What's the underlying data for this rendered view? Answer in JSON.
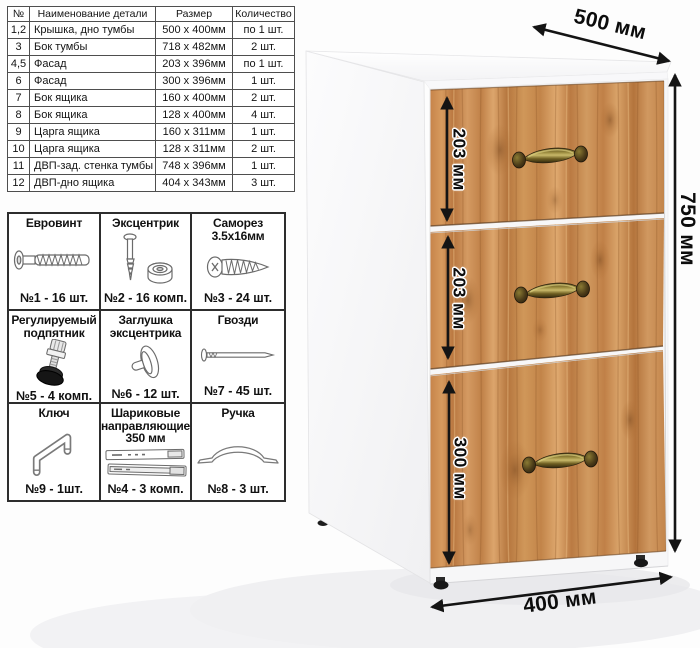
{
  "parts_table": {
    "headers": [
      "№",
      "Наименование детали",
      "Размер",
      "Количество"
    ],
    "rows": [
      [
        "1,2",
        "Крышка, дно тумбы",
        "500 х 400мм",
        "по 1 шт."
      ],
      [
        "3",
        "Бок тумбы",
        "718 х 482мм",
        "2 шт."
      ],
      [
        "4,5",
        "Фасад",
        "203 х 396мм",
        "по 1 шт."
      ],
      [
        "6",
        "Фасад",
        "300 х 396мм",
        "1 шт."
      ],
      [
        "7",
        "Бок ящика",
        "160 х 400мм",
        "2 шт."
      ],
      [
        "8",
        "Бок ящика",
        "128 х 400мм",
        "4 шт."
      ],
      [
        "9",
        "Царга ящика",
        "160 х 311мм",
        "1 шт."
      ],
      [
        "10",
        "Царга ящика",
        "128 х 311мм",
        "2 шт."
      ],
      [
        "11",
        "ДВП-зад. стенка тумбы",
        "748 х 396мм",
        "1 шт."
      ],
      [
        "12",
        "ДВП-дно ящика",
        "404 х 343мм",
        "3 шт."
      ]
    ]
  },
  "hardware": {
    "items": [
      {
        "name": "Евровинт",
        "qty": "№1 - 16 шт.",
        "icon": "euro-screw-icon"
      },
      {
        "name": "Эксцентрик",
        "qty": "№2 - 16 комп.",
        "icon": "cam-lock-icon"
      },
      {
        "name": "Саморез 3.5х16мм",
        "qty": "№3 - 24 шт.",
        "icon": "self-tapping-screw-icon"
      },
      {
        "name": "Регулируемый подпятник",
        "qty": "№5 - 4 комп.",
        "icon": "adjustable-foot-icon"
      },
      {
        "name": "Заглушка эксцентрика",
        "qty": "№6 - 12 шт.",
        "icon": "cam-cover-icon"
      },
      {
        "name": "Гвозди",
        "qty": "№7 - 45 шт.",
        "icon": "nail-icon"
      },
      {
        "name": "Ключ",
        "qty": "№9 - 1шт.",
        "icon": "hex-key-icon"
      },
      {
        "name": "Шариковые направляющие 350 мм",
        "qty": "№4 - 3 комп.",
        "icon": "ball-slides-icon"
      },
      {
        "name": "Ручка",
        "qty": "№8 - 3 шт.",
        "icon": "bow-handle-icon"
      }
    ]
  },
  "cabinet": {
    "dim_width": "500 мм",
    "dim_height": "750 мм",
    "dim_depth": "400 мм",
    "dim_drawer1": "203 мм",
    "dim_drawer2": "203 мм",
    "dim_drawer3": "300 мм",
    "drawer_count": "3"
  },
  "colors": {
    "wood_mid": "#c8854d",
    "wood_light": "#dda76c",
    "wood_dark": "#a96b38",
    "handle_brass": "#9c8c3f",
    "body_white": "#f7f7f8",
    "dimension_text": "#0c0c0c"
  }
}
